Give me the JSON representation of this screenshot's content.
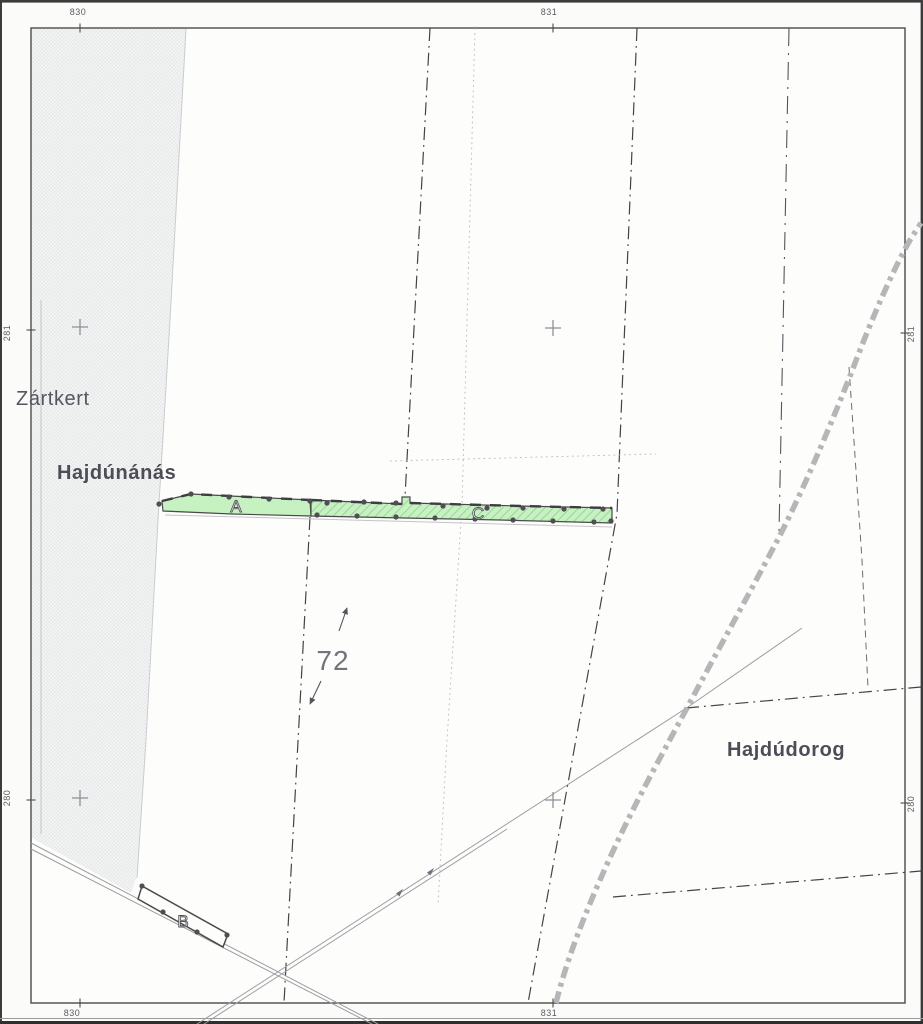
{
  "map": {
    "grid_labels": {
      "top_left": "830",
      "top_right": "831",
      "bottom_left": "830",
      "bottom_right": "831",
      "left_top": "281",
      "left_bottom": "280",
      "right_top": "281",
      "right_bottom": "280"
    },
    "place_labels": {
      "zartkert": "Zártkert",
      "hajdunanas": "Hajdúnánás",
      "hajdudorog": "Hajdúdorog"
    },
    "parcel_labels": {
      "a": "A",
      "b": "B",
      "c": "C",
      "number": "72"
    },
    "colors": {
      "parcel_fill": "#c6f2c2",
      "parcel_hatch": "#96c996",
      "parcel_outline": "#4a4a4a",
      "railway": "#b6b6b8",
      "shading_base": "#f5f6f4",
      "shading_dot": "#e4e7e9",
      "dark_text": "#4d4d57"
    }
  }
}
